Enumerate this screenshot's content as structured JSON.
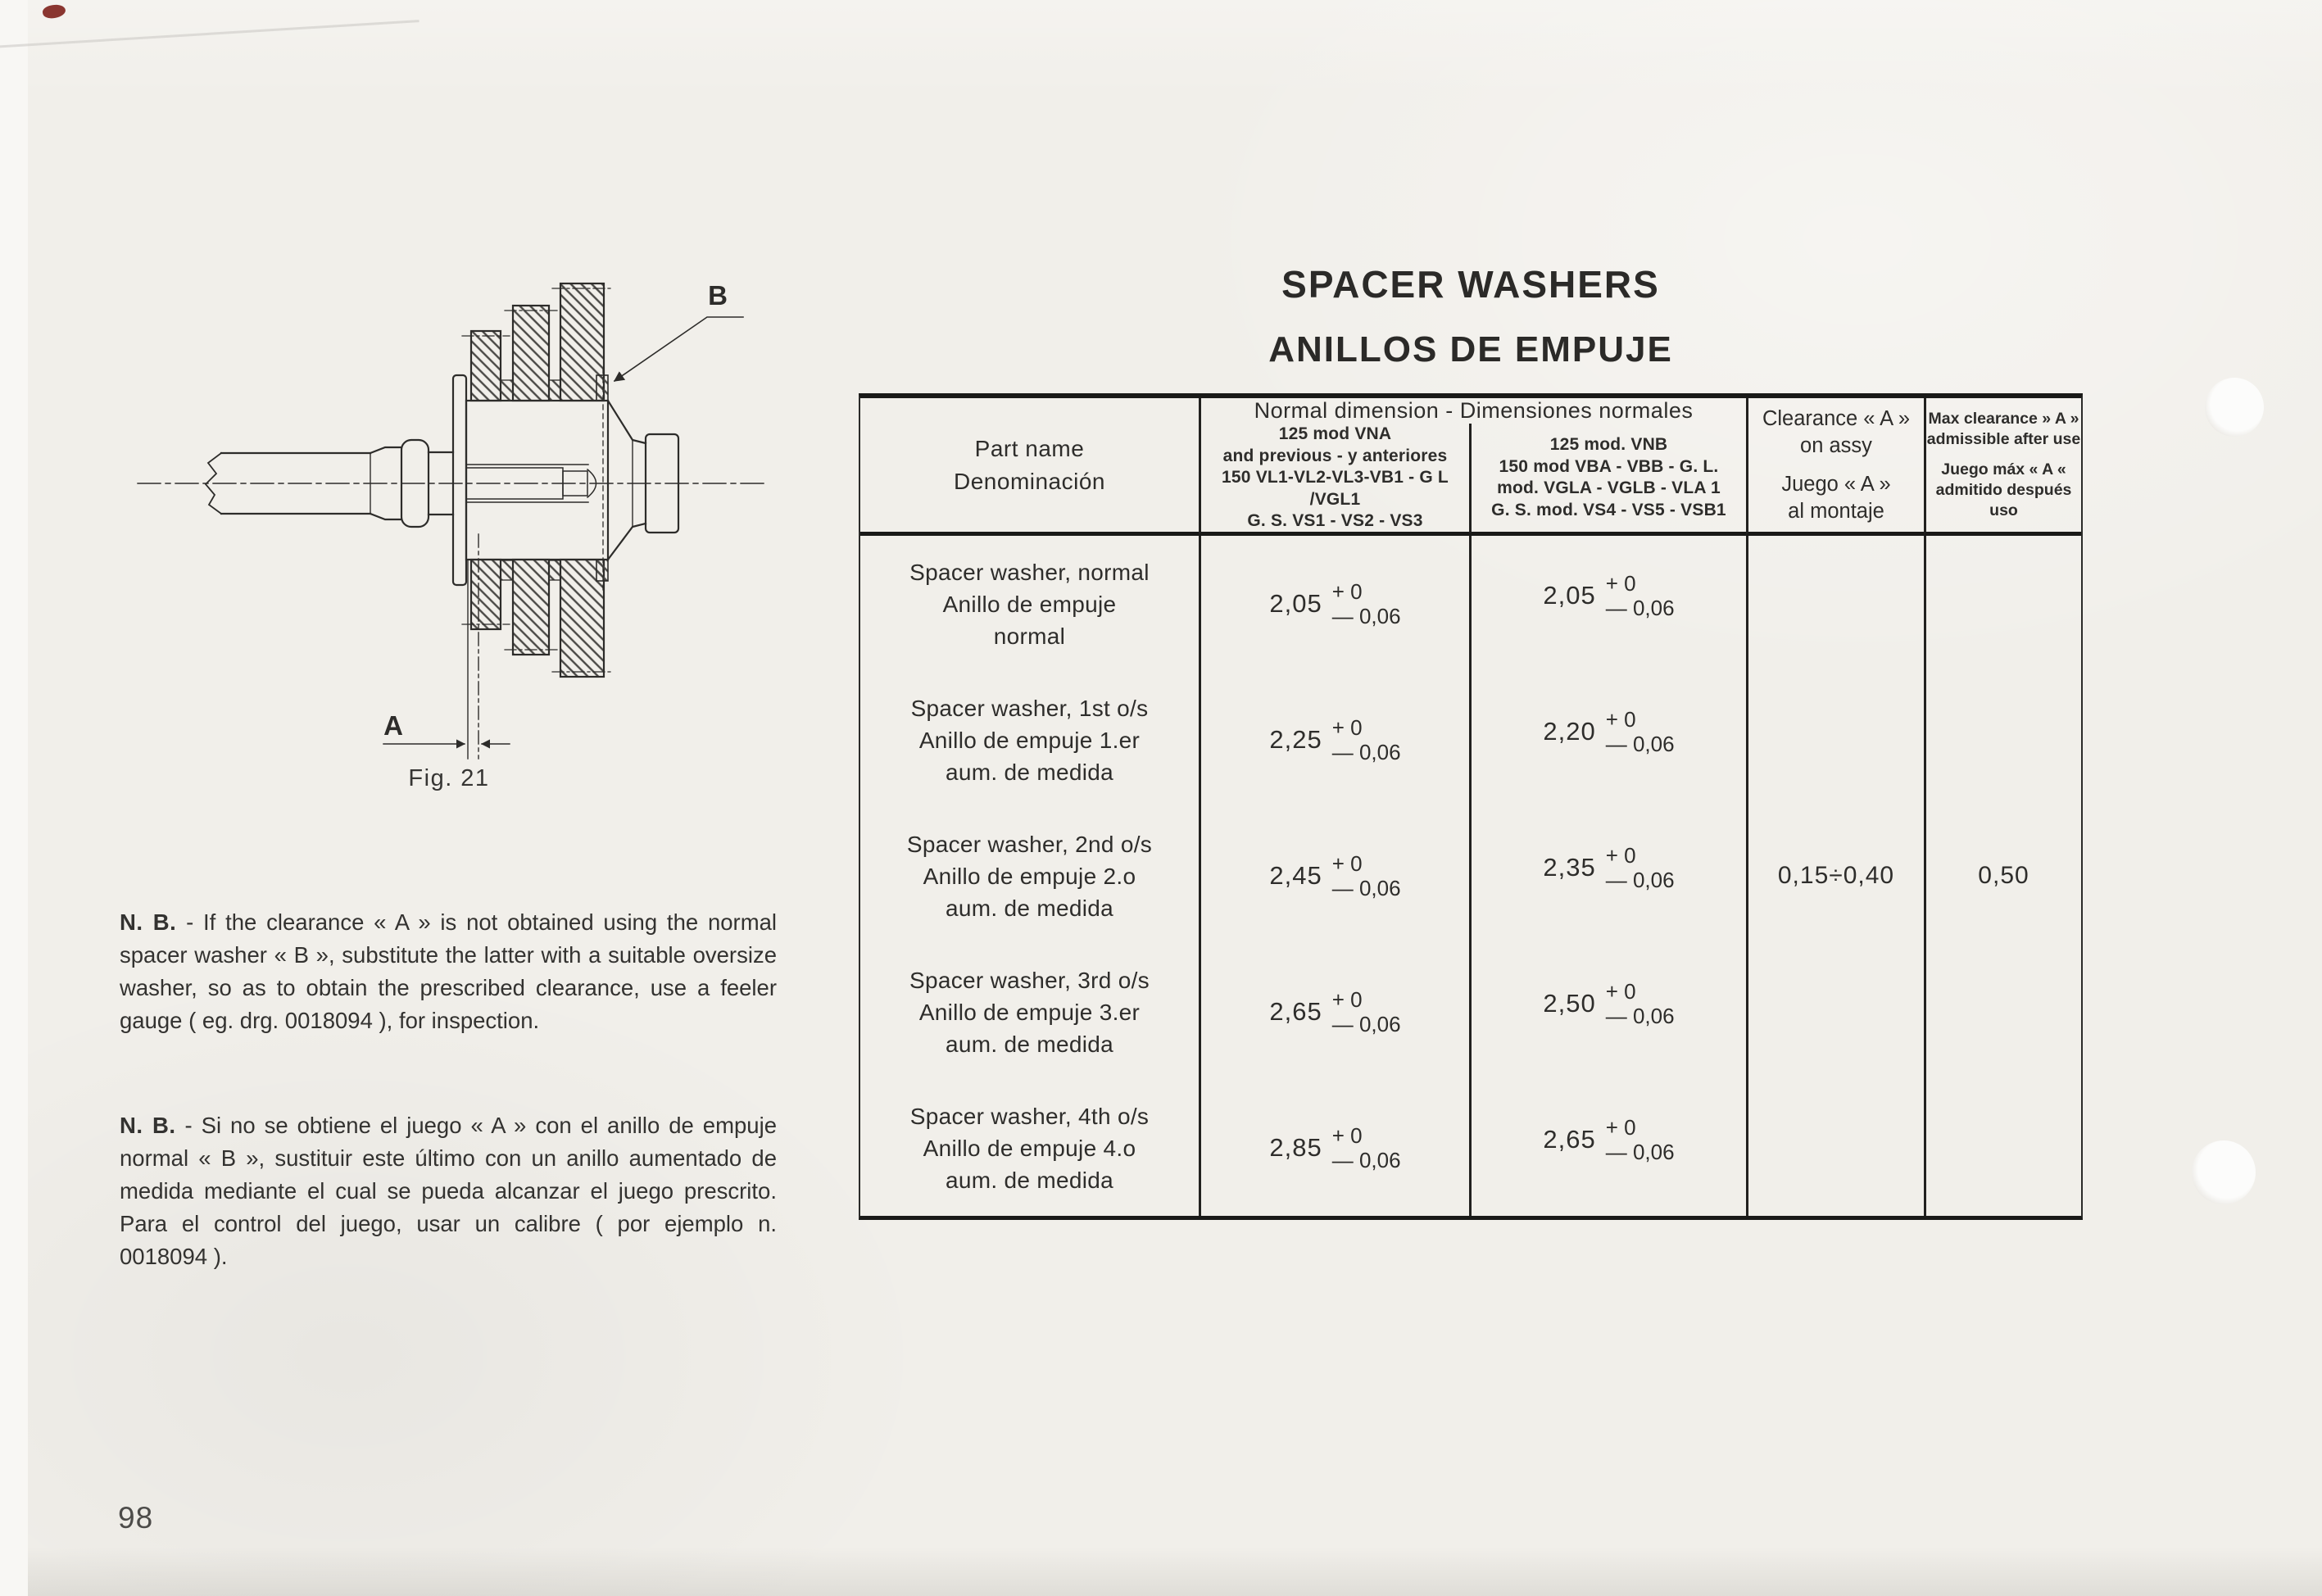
{
  "title": {
    "en": "SPACER WASHERS",
    "es": "ANILLOS DE EMPUJE"
  },
  "table": {
    "header": {
      "part_name_en": "Part name",
      "part_name_es": "Denominación",
      "normal_dimension": "Normal dimension   -   Dimensiones normales",
      "vna_lines": [
        "125 mod  VNA",
        "and previous  -  y anteriores",
        "150 VL1-VL2-VL3-VB1  -  G L /VGL1",
        "G. S.  VS1 - VS2 - VS3"
      ],
      "vnb_lines": [
        "125 mod.  VNB",
        "150 mod  VBA - VBB  -  G. L.",
        "mod. VGLA - VGLB - VLA 1",
        "G. S. mod. VS4 - VS5 - VSB1"
      ],
      "clearance_lines": [
        "Clearance « A »",
        "on assy",
        "Juego « A »",
        "al montaje"
      ],
      "max_clearance_lines": [
        "Max clearance » A »",
        "admissible after use",
        "Juego máx « A «",
        "admitido después uso"
      ]
    },
    "rows": [
      {
        "name": [
          "Spacer washer, normal",
          "Anillo de empuje",
          "normal"
        ],
        "vna": {
          "v": "2,05",
          "p": "+ 0",
          "m": "— 0,06"
        },
        "vnb": {
          "v": "2,05",
          "p": "+ 0",
          "m": "— 0,06"
        }
      },
      {
        "name": [
          "Spacer washer, 1st o/s",
          "Anillo de empuje 1.er",
          "aum.  de  medida"
        ],
        "vna": {
          "v": "2,25",
          "p": "+ 0",
          "m": "— 0,06"
        },
        "vnb": {
          "v": "2,20",
          "p": "+ 0",
          "m": "— 0,06"
        }
      },
      {
        "name": [
          "Spacer washer, 2nd o/s",
          "Anillo de empuje 2.o",
          "aum.  de  medida"
        ],
        "vna": {
          "v": "2,45",
          "p": "+ 0",
          "m": "— 0,06"
        },
        "vnb": {
          "v": "2,35",
          "p": "+ 0",
          "m": "— 0,06"
        }
      },
      {
        "name": [
          "Spacer washer, 3rd o/s",
          "Anillo de empuje 3.er",
          "aum.  de  medida"
        ],
        "vna": {
          "v": "2,65",
          "p": "+ 0",
          "m": "— 0,06"
        },
        "vnb": {
          "v": "2,50",
          "p": "+ 0",
          "m": "— 0,06"
        }
      },
      {
        "name": [
          "Spacer washer, 4th o/s",
          "Anillo de empuje 4.o",
          "aum.  de  medida"
        ],
        "vna": {
          "v": "2,85",
          "p": "+ 0",
          "m": "— 0,06"
        },
        "vnb": {
          "v": "2,65",
          "p": "+ 0",
          "m": "— 0,06"
        }
      }
    ],
    "clearance_on_assy": "0,15÷0,40",
    "max_clearance": "0,50"
  },
  "notes": {
    "en_lead": "N. B.",
    "en_body": "- If the clearance « A » is not obtained using the normal spacer washer « B », substitute the latter with a suitable oversize washer, so as to obtain the prescribed clearance, use a feeler gauge ( eg. drg. 0018094 ), for inspection.",
    "es_lead": "N. B.",
    "es_body": "- Si no se obtiene el juego « A » con el anillo de empuje normal « B », sustituir este último con un anillo aumentado de medida mediante el cual se pueda alcanzar el juego prescrito. Para el control del juego, usar un calibre ( por ejemplo n. 0018094 )."
  },
  "figure": {
    "caption": "Fig. 21",
    "label_a": "A",
    "label_b": "B"
  },
  "page_number": "98"
}
